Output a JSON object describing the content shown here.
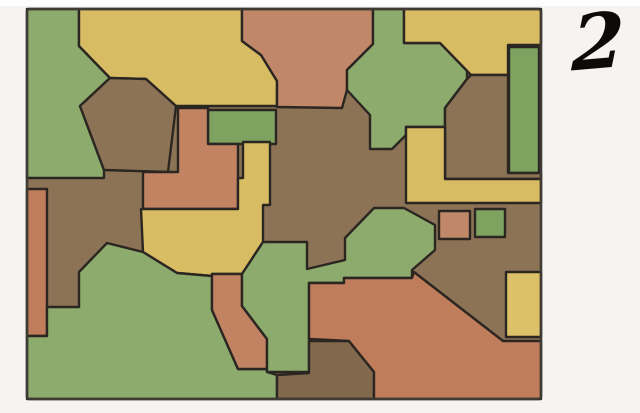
{
  "figure": {
    "kind": "map-coloring puzzle",
    "number_label": "2"
  },
  "palette": {
    "green": "#8cab6c",
    "green2": "#7ea25f",
    "yellow": "#d8bc63",
    "yellow2": "#ddc168",
    "orange": "#c28363",
    "orange2": "#c08868",
    "orange3": "#bf7d5b",
    "brown": "#8c7356",
    "brown2": "#8d7355",
    "brown3": "#82694d",
    "line": "#2b2621",
    "border": "#3f3a33",
    "page_bg": "#f5f4f1"
  },
  "map": {
    "frame": {
      "x": 27,
      "y": 9,
      "width": 514,
      "height": 390
    },
    "base_color": "brown",
    "stroke_width": 2.4,
    "regions": [
      {
        "name": "green-topleft",
        "color": "green",
        "points": "27,9 79,9 79,46 110,78 80,106 104,170 104,178 27,178"
      },
      {
        "name": "yellow-top",
        "color": "yellow",
        "points": "79,9 242,9 242,41 261,55 277,81 277,106 176,106 146,79 110,78 79,46"
      },
      {
        "name": "brown-hexagon",
        "color": "brown2",
        "points": "80,106 110,78 146,79 176,106 168,172 104,170"
      },
      {
        "name": "orange-top",
        "color": "orange2",
        "points": "242,9 373,9 373,44 347,70 347,90 342,108 277,107 277,81 261,55 242,41"
      },
      {
        "name": "green-arrow",
        "color": "green",
        "points": "373,9 404,9 404,43 440,43 467,70 467,79 445,108 445,127 406,127 406,135 392,149 370,149 370,115 347,90 347,70 373,44"
      },
      {
        "name": "yellow-topright",
        "color": "yellow",
        "points": "404,9 541,9 541,45 508,45 508,75 471,75 440,43 404,43"
      },
      {
        "name": "green-bar",
        "color": "green2",
        "points": "509,47 539,47 539,173 509,173"
      },
      {
        "name": "brown-right",
        "color": "brown",
        "points": "471,75 508,75 508,173 541,173 541,179 445,179 445,108 467,79"
      },
      {
        "name": "yellow-L",
        "color": "yellow",
        "points": "406,127 445,127 445,179 541,179 541,203 406,203"
      },
      {
        "name": "green-rect",
        "color": "green2",
        "points": "208,110 276,110 276,144 208,144"
      },
      {
        "name": "orange-T",
        "color": "orange",
        "points": "178,108 208,108 208,144 238,144 238,209 143,209 143,172 178,172"
      },
      {
        "name": "yellow-center",
        "color": "yellow",
        "points": "243,142 270,142 270,205 263,205 263,242 242,274 212,274 212,276 177,273 143,252 141,209 238,209 238,178 243,178"
      },
      {
        "name": "orange-left-bar",
        "color": "orange3",
        "points": "27,189 47,189 47,336 27,336"
      },
      {
        "name": "green-bottom",
        "color": "green",
        "points": "27,336 47,336 47,307 79,307 79,272 107,243 143,252 177,273 212,276 212,310 238,369 267,369 267,372 277,375 277,399 27,399"
      },
      {
        "name": "orange-blob",
        "color": "orange",
        "points": "212,274 242,274 242,306 267,339 267,369 238,369 212,310"
      },
      {
        "name": "green-mid",
        "color": "green",
        "points": "263,242 307,242 307,269 345,260 345,238 374,208 404,208 435,225 435,250 412,270 412,278 344,278 344,283 309,283 309,372 267,372 267,339 242,306 242,274"
      },
      {
        "name": "brown-bottom",
        "color": "brown3",
        "points": "309,341 349,341 374,372 374,399 277,399 277,375 309,373"
      },
      {
        "name": "orange-bottomright",
        "color": "orange3",
        "points": "309,283 344,283 344,278 412,278 414,272 503,341 541,341 541,399 374,399 374,372 349,341 309,339"
      },
      {
        "name": "yellow-right-rect",
        "color": "yellow2",
        "points": "506,272 541,272 541,337 506,337"
      },
      {
        "name": "orange-square",
        "color": "orange2",
        "points": "439,211 470,211 470,239 439,239"
      },
      {
        "name": "green-square",
        "color": "green2",
        "points": "475,209 505,209 505,237 475,237"
      }
    ]
  }
}
